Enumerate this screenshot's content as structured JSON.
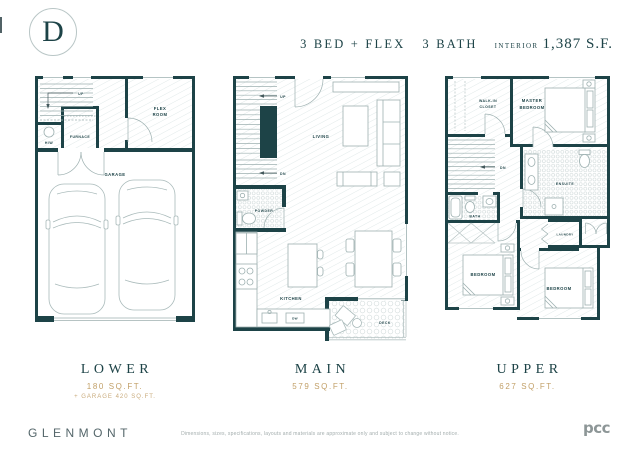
{
  "badge": {
    "letter": "D"
  },
  "header": {
    "beds": "3 BED + FLEX",
    "baths": "3 BATH",
    "interior_label": "INTERIOR",
    "interior_value": "1,387 S.F."
  },
  "plans": {
    "lower": {
      "caption": "LOWER",
      "area": "180 SQ.FT.",
      "area_note": "+ GARAGE 420 SQ.FT.",
      "labels": {
        "up": "UP",
        "flex_l1": "FLEX",
        "flex_l2": "ROOM",
        "hw": "H/W",
        "furnace": "FURNACE",
        "garage": "GARAGE"
      }
    },
    "main": {
      "caption": "MAIN",
      "area": "579 SQ.FT.",
      "labels": {
        "up": "UP",
        "dn": "DN",
        "living": "LIVING",
        "powder": "POWDER",
        "kitchen": "KITCHEN",
        "dw": "DW",
        "deck": "DECK"
      }
    },
    "upper": {
      "caption": "UPPER",
      "area": "627 SQ.FT.",
      "labels": {
        "walkin_l1": "WALK-IN",
        "walkin_l2": "CLOSET",
        "master_l1": "MASTER",
        "master_l2": "BEDROOM",
        "dn": "DN",
        "ensuite": "ENSUITE",
        "bath": "BATH",
        "laundry": "LAUNDRY",
        "bedroom_left": "BEDROOM",
        "bedroom_right": "BEDROOM"
      }
    }
  },
  "footer": {
    "brand": "GLENMONT",
    "disclaimer": "Dimensions, sizes, specifications, layouts and materials are approximate only and subject to change without notice.",
    "logo": "pcc"
  },
  "colors": {
    "wall": "#1d4347",
    "gold": "#c2a068",
    "fixture_line": "#9db0b0"
  }
}
